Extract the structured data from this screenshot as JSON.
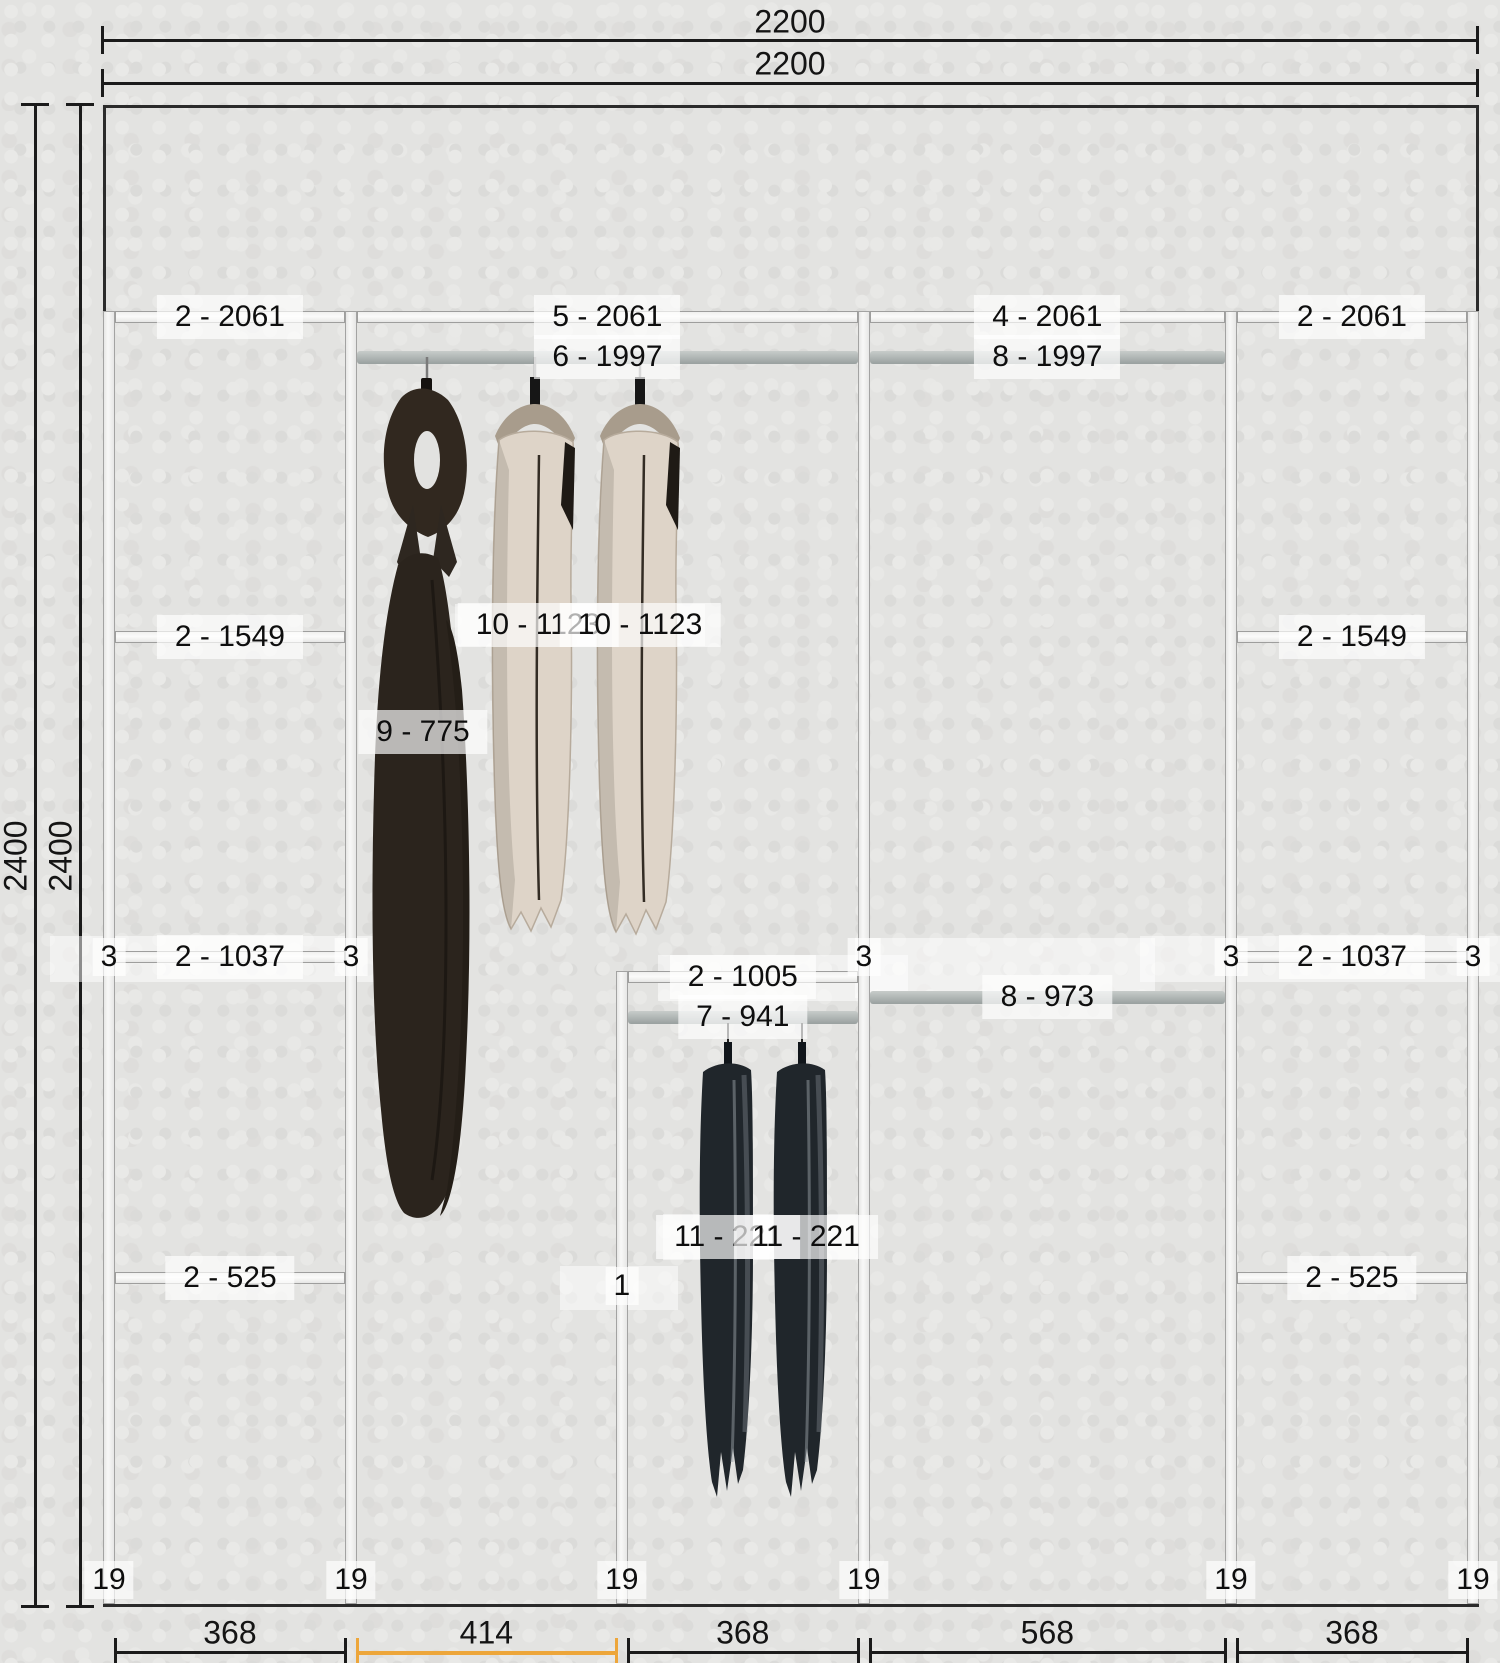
{
  "drawing": {
    "unit": "mm",
    "total_width_label": "2200",
    "total_height_label": "2400",
    "top_dims": [
      "2200",
      "2200"
    ],
    "side_dims": [
      "2400",
      "2400"
    ],
    "bottom_dims": [
      {
        "label": "368",
        "highlight": false
      },
      {
        "label": "414",
        "highlight": true
      },
      {
        "label": "368",
        "highlight": false
      },
      {
        "label": "568",
        "highlight": false
      },
      {
        "label": "368",
        "highlight": false
      }
    ],
    "highlight_color": "#eda63a",
    "panel_thickness_label": "19",
    "panels": [
      {
        "id": "panel-1",
        "x_mm": 0,
        "height_mm": 2061,
        "label": "3"
      },
      {
        "id": "panel-2",
        "x_mm": 387,
        "height_mm": 2061,
        "label": "3"
      },
      {
        "id": "panel-3",
        "x_mm": 820,
        "height_mm": 1005,
        "label": "1"
      },
      {
        "id": "panel-4",
        "x_mm": 1207,
        "height_mm": 2061,
        "label": "3"
      },
      {
        "id": "panel-5",
        "x_mm": 1794,
        "height_mm": 2061,
        "label": "3"
      },
      {
        "id": "panel-6",
        "x_mm": 2181,
        "height_mm": 2061,
        "label": "3"
      }
    ],
    "shelves": [
      {
        "from_mm": 19,
        "to_mm": 387,
        "h_mm": 2061,
        "label": "2 - 2061"
      },
      {
        "from_mm": 19,
        "to_mm": 387,
        "h_mm": 1549,
        "label": "2 - 1549"
      },
      {
        "from_mm": 19,
        "to_mm": 387,
        "h_mm": 1037,
        "label": "2 - 1037"
      },
      {
        "from_mm": 19,
        "to_mm": 387,
        "h_mm": 525,
        "label": "2 - 525"
      },
      {
        "from_mm": 406,
        "to_mm": 1207,
        "h_mm": 2061,
        "label": "5 - 2061"
      },
      {
        "from_mm": 839,
        "to_mm": 1207,
        "h_mm": 1005,
        "label": "2 - 1005"
      },
      {
        "from_mm": 1226,
        "to_mm": 1794,
        "h_mm": 2061,
        "label": "4 - 2061"
      },
      {
        "from_mm": 1813,
        "to_mm": 2181,
        "h_mm": 2061,
        "label": "2 - 2061"
      },
      {
        "from_mm": 1813,
        "to_mm": 2181,
        "h_mm": 1549,
        "label": "2 - 1549"
      },
      {
        "from_mm": 1813,
        "to_mm": 2181,
        "h_mm": 1037,
        "label": "2 - 1037"
      },
      {
        "from_mm": 1813,
        "to_mm": 2181,
        "h_mm": 525,
        "label": "2 - 525"
      }
    ],
    "rods": [
      {
        "from_mm": 406,
        "to_mm": 1207,
        "h_mm": 1997,
        "label": "6 - 1997"
      },
      {
        "from_mm": 1226,
        "to_mm": 1794,
        "h_mm": 1997,
        "label": "8 - 1997"
      },
      {
        "from_mm": 1226,
        "to_mm": 1794,
        "h_mm": 973,
        "label": "8 - 973"
      },
      {
        "from_mm": 839,
        "to_mm": 1207,
        "h_mm": 941,
        "label": "7 - 941"
      }
    ],
    "garment_labels": [
      {
        "label": "9 - 775",
        "x": 423,
        "y": 732
      },
      {
        "label": "10 - 1123",
        "x": 538,
        "y": 625
      },
      {
        "label": "10 - 1123",
        "x": 640,
        "y": 625
      },
      {
        "label": "11 - 221",
        "x": 728,
        "y": 1237
      },
      {
        "label": "11 - 221",
        "x": 806,
        "y": 1237
      }
    ]
  }
}
